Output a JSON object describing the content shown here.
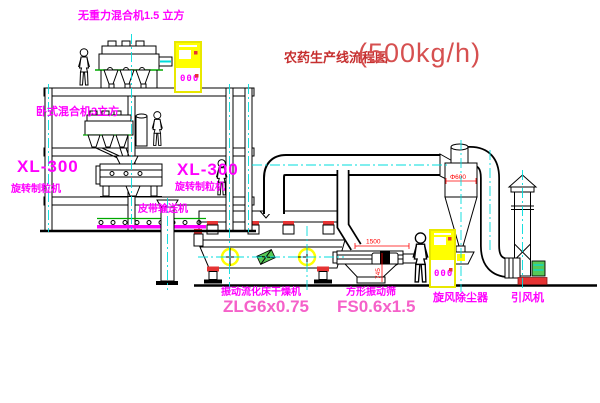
{
  "title": {
    "name_cn": "农药生产线流程图",
    "capacity": "(500kg/h)"
  },
  "equipment_labels": {
    "top_mixer": "无重力混合机1.5 立方",
    "second_mixer": "卧式混合机3立方",
    "granulator_left": {
      "model": "XL-300",
      "name": "旋转制粒机"
    },
    "granulator_right": {
      "model": "XL-300",
      "name": "旋转制粒机"
    },
    "belt_conveyor": "皮带输送机",
    "dryer": {
      "name": "振动流化床干燥机",
      "model": "ZLG6x0.75"
    },
    "sieve": {
      "name": "方形振动筛",
      "model": "FS0.6x1.5"
    },
    "cyclone": "旋风除尘器",
    "fan": "引风机"
  },
  "dimensions": {
    "sieve_length": "1500",
    "sieve_height": "745",
    "cyclone_diameter": "Φ600"
  },
  "control_cabinets": {
    "roof_display": "000",
    "floor_display": "000"
  },
  "colors": {
    "label_magenta": "#ff00ff",
    "model_pink": "#f561c9",
    "title_red": "#c62f2f",
    "dimension_red": "#ff0000",
    "cabinet_yellow": "#ffff00",
    "centerline_cyan": "#00dcdc",
    "machine_green": "#00a800"
  }
}
